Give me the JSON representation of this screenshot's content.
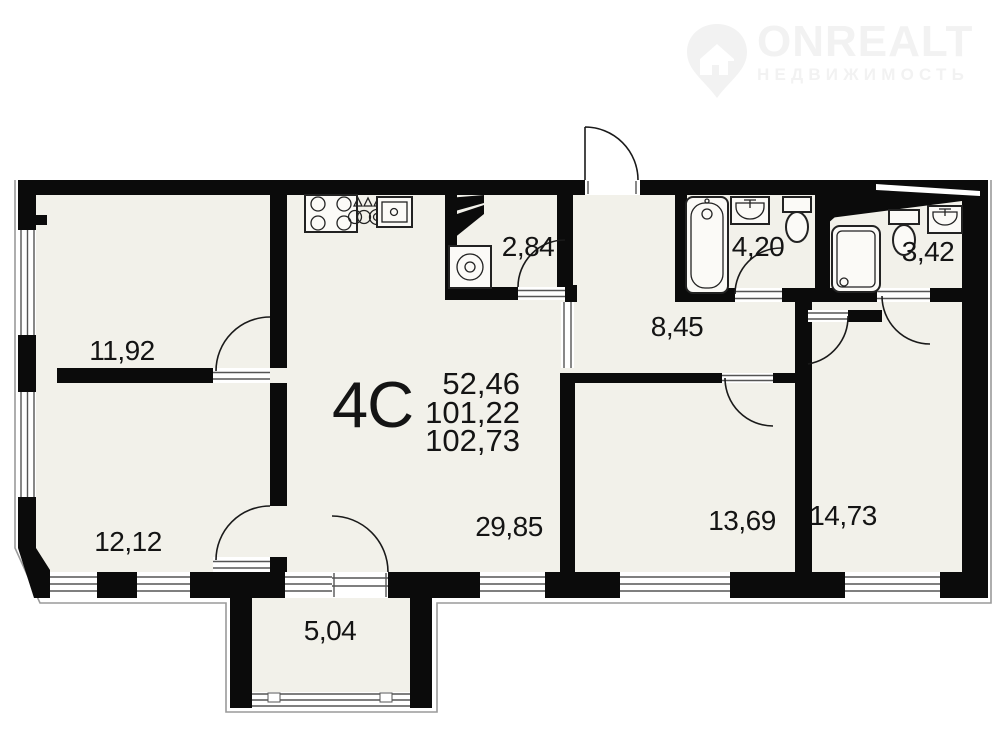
{
  "logo": {
    "brand": "ONREALT",
    "tagline": "НЕДВИЖИМОСТЬ"
  },
  "unit": {
    "label": "4C",
    "area_living": "52,46",
    "area_total": "101,22",
    "area_full": "102,73"
  },
  "rooms": [
    {
      "name": "bedroom-1",
      "area": "11,92",
      "x": 122,
      "y": 351
    },
    {
      "name": "bedroom-2",
      "area": "12,12",
      "x": 128,
      "y": 542
    },
    {
      "name": "laundry",
      "area": "2,84",
      "x": 528,
      "y": 247
    },
    {
      "name": "bathroom",
      "area": "4,20",
      "x": 758,
      "y": 247
    },
    {
      "name": "shower-room",
      "area": "3,42",
      "x": 928,
      "y": 252
    },
    {
      "name": "hallway",
      "area": "8,45",
      "x": 677,
      "y": 327
    },
    {
      "name": "kitchen-living",
      "area": "29,85",
      "x": 509,
      "y": 527
    },
    {
      "name": "room-3",
      "area": "13,69",
      "x": 742,
      "y": 521
    },
    {
      "name": "room-4",
      "area": "14,73",
      "x": 843,
      "y": 516
    },
    {
      "name": "balcony",
      "area": "5,04",
      "x": 330,
      "y": 631
    }
  ],
  "fixture_icons": [
    "stove-icon",
    "gas-burners-icon",
    "kitchen-sink-icon",
    "washing-machine-icon",
    "bathtub-icon",
    "wash-basin-icon",
    "toilet-icon",
    "shower-cabin-icon",
    "toilet-2-icon",
    "wash-basin-2-icon"
  ],
  "colors": {
    "wall": "#0b0b0b",
    "floor": "#f2f1ea",
    "sill_line": "#555555",
    "outer_line": "#9a9a9a",
    "fixture_line": "#222222",
    "label_ink": "#141414",
    "logo_gray": "#f2f2f2"
  }
}
